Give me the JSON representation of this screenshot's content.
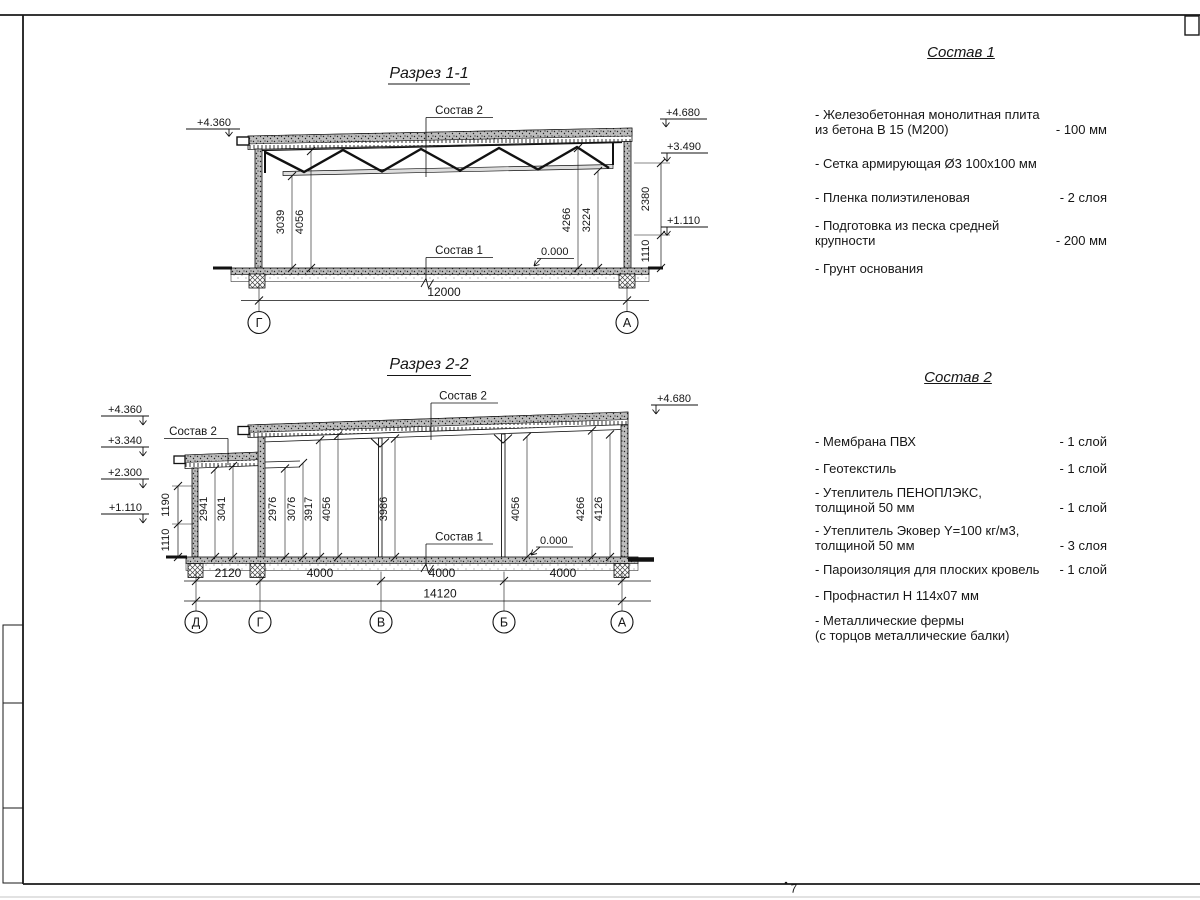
{
  "frame": {
    "page_mark": "7"
  },
  "s1": {
    "title": "Разрез 1-1",
    "lbl_sostav2": "Состав 2",
    "lbl_sostav1": "Состав 1",
    "zero": "0.000",
    "elev_left": "+4.360",
    "elev_r1": "+4.680",
    "elev_r2": "+3.490",
    "elev_r3": "+1.110",
    "dim_l1": "3039",
    "dim_l2": "4056",
    "dim_r1": "4266",
    "dim_r2": "3224",
    "chain1": "2380",
    "chain2": "1110",
    "total": "12000",
    "grid_l": "Г",
    "grid_r": "А"
  },
  "s2": {
    "title": "Разрез 2-2",
    "lbl_sostav2_annex": "Состав 2",
    "lbl_sostav2_main": "Состав 2",
    "lbl_sostav1": "Состав 1",
    "zero": "0.000",
    "elev_l1": "+4.360",
    "elev_l2": "+3.340",
    "elev_l3": "+2.300",
    "elev_l4": "+1.110",
    "elev_r": "+4.680",
    "chain1": "1190",
    "chain2": "1110",
    "dim_a1": "2941",
    "dim_a2": "3041",
    "dim_m1": "2976",
    "dim_m2": "3076",
    "dim_m3": "3917",
    "dim_m4": "4056",
    "dim_m5": "3986",
    "dim_m6": "4056",
    "dim_m7": "4266",
    "dim_m8": "4126",
    "seg1": "2120",
    "seg2": "4000",
    "seg3": "4000",
    "seg4": "4000",
    "total": "14120",
    "grids": [
      "Д",
      "Г",
      "В",
      "Б",
      "А"
    ]
  },
  "sostav1": {
    "title": "Состав 1",
    "items": [
      {
        "name": "- Железобетонная  монолитная плита\nиз бетона В 15 (М200)",
        "value": "- 100 мм"
      },
      {
        "name": "- Сетка армирующая Ø3 100х100 мм",
        "value": ""
      },
      {
        "name": "- Пленка полиэтиленовая",
        "value": "-  2 слоя"
      },
      {
        "name": "- Подготовка из песка средней\nкрупности",
        "value": "- 200 мм"
      },
      {
        "name": "- Грунт основания",
        "value": ""
      }
    ]
  },
  "sostav2": {
    "title": "Состав 2",
    "items": [
      {
        "name": "- Мембрана ПВХ",
        "value": "- 1 слой"
      },
      {
        "name": "- Геотекстиль",
        "value": "- 1 слой"
      },
      {
        "name": "- Утеплитель ПЕНОПЛЭКС,\nтолщиной 50 мм",
        "value": "- 1 слой"
      },
      {
        "name": "- Утеплитель Эковер Y=100 кг/м3,\nтолщиной 50 мм",
        "value": "- 3 слоя"
      },
      {
        "name": "- Пароизоляция для плоских кровель",
        "value": "- 1 слой"
      },
      {
        "name": "- Профнастил Н 114х07 мм",
        "value": ""
      },
      {
        "name": "- Металлические фермы\n(с торцов металлические балки)",
        "value": ""
      }
    ]
  }
}
